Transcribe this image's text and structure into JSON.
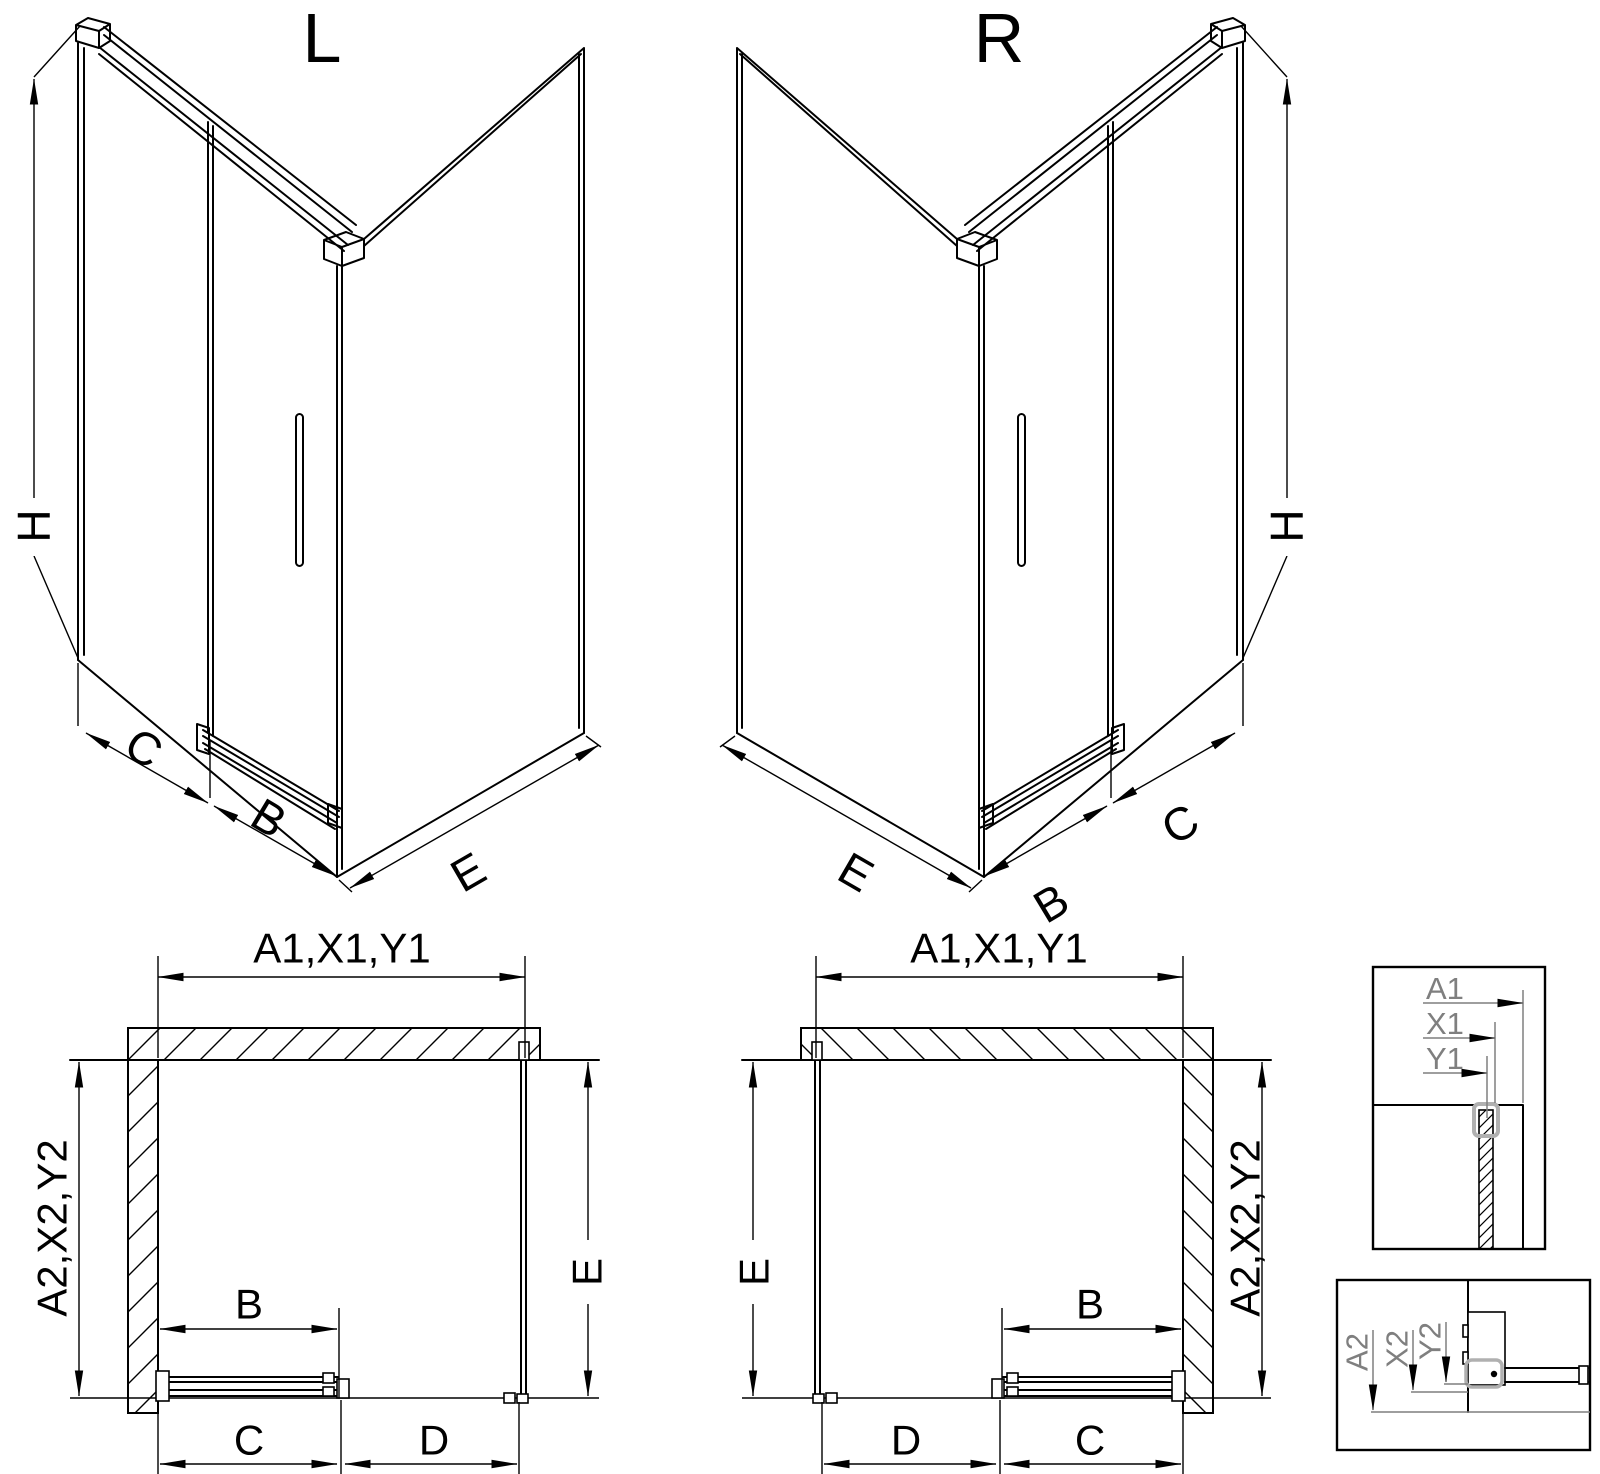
{
  "iso_left": {
    "title": "L",
    "h": "H",
    "c": "C",
    "b": "B",
    "e": "E"
  },
  "iso_right": {
    "title": "R",
    "h": "H",
    "c": "C",
    "b": "B",
    "e": "E"
  },
  "plan_left": {
    "top": "A1,X1,Y1",
    "left": "A2,X2,Y2",
    "right": "E",
    "door": "B",
    "bottom_inner": "C",
    "bottom_outer": "D"
  },
  "plan_right": {
    "top": "A1,X1,Y1",
    "left": "E",
    "right": "A2,X2,Y2",
    "door": "B",
    "bottom_outer": "D",
    "bottom_inner": "C"
  },
  "detail_top": {
    "a1": "A1",
    "x1": "X1",
    "y1": "Y1"
  },
  "detail_bottom": {
    "a2": "A2",
    "x2": "X2",
    "y2": "Y2"
  },
  "colors": {
    "background": "#ffffff",
    "line": "#000000",
    "detail_dim": "#7f7f7f",
    "highlight": "#b0b0b0"
  }
}
